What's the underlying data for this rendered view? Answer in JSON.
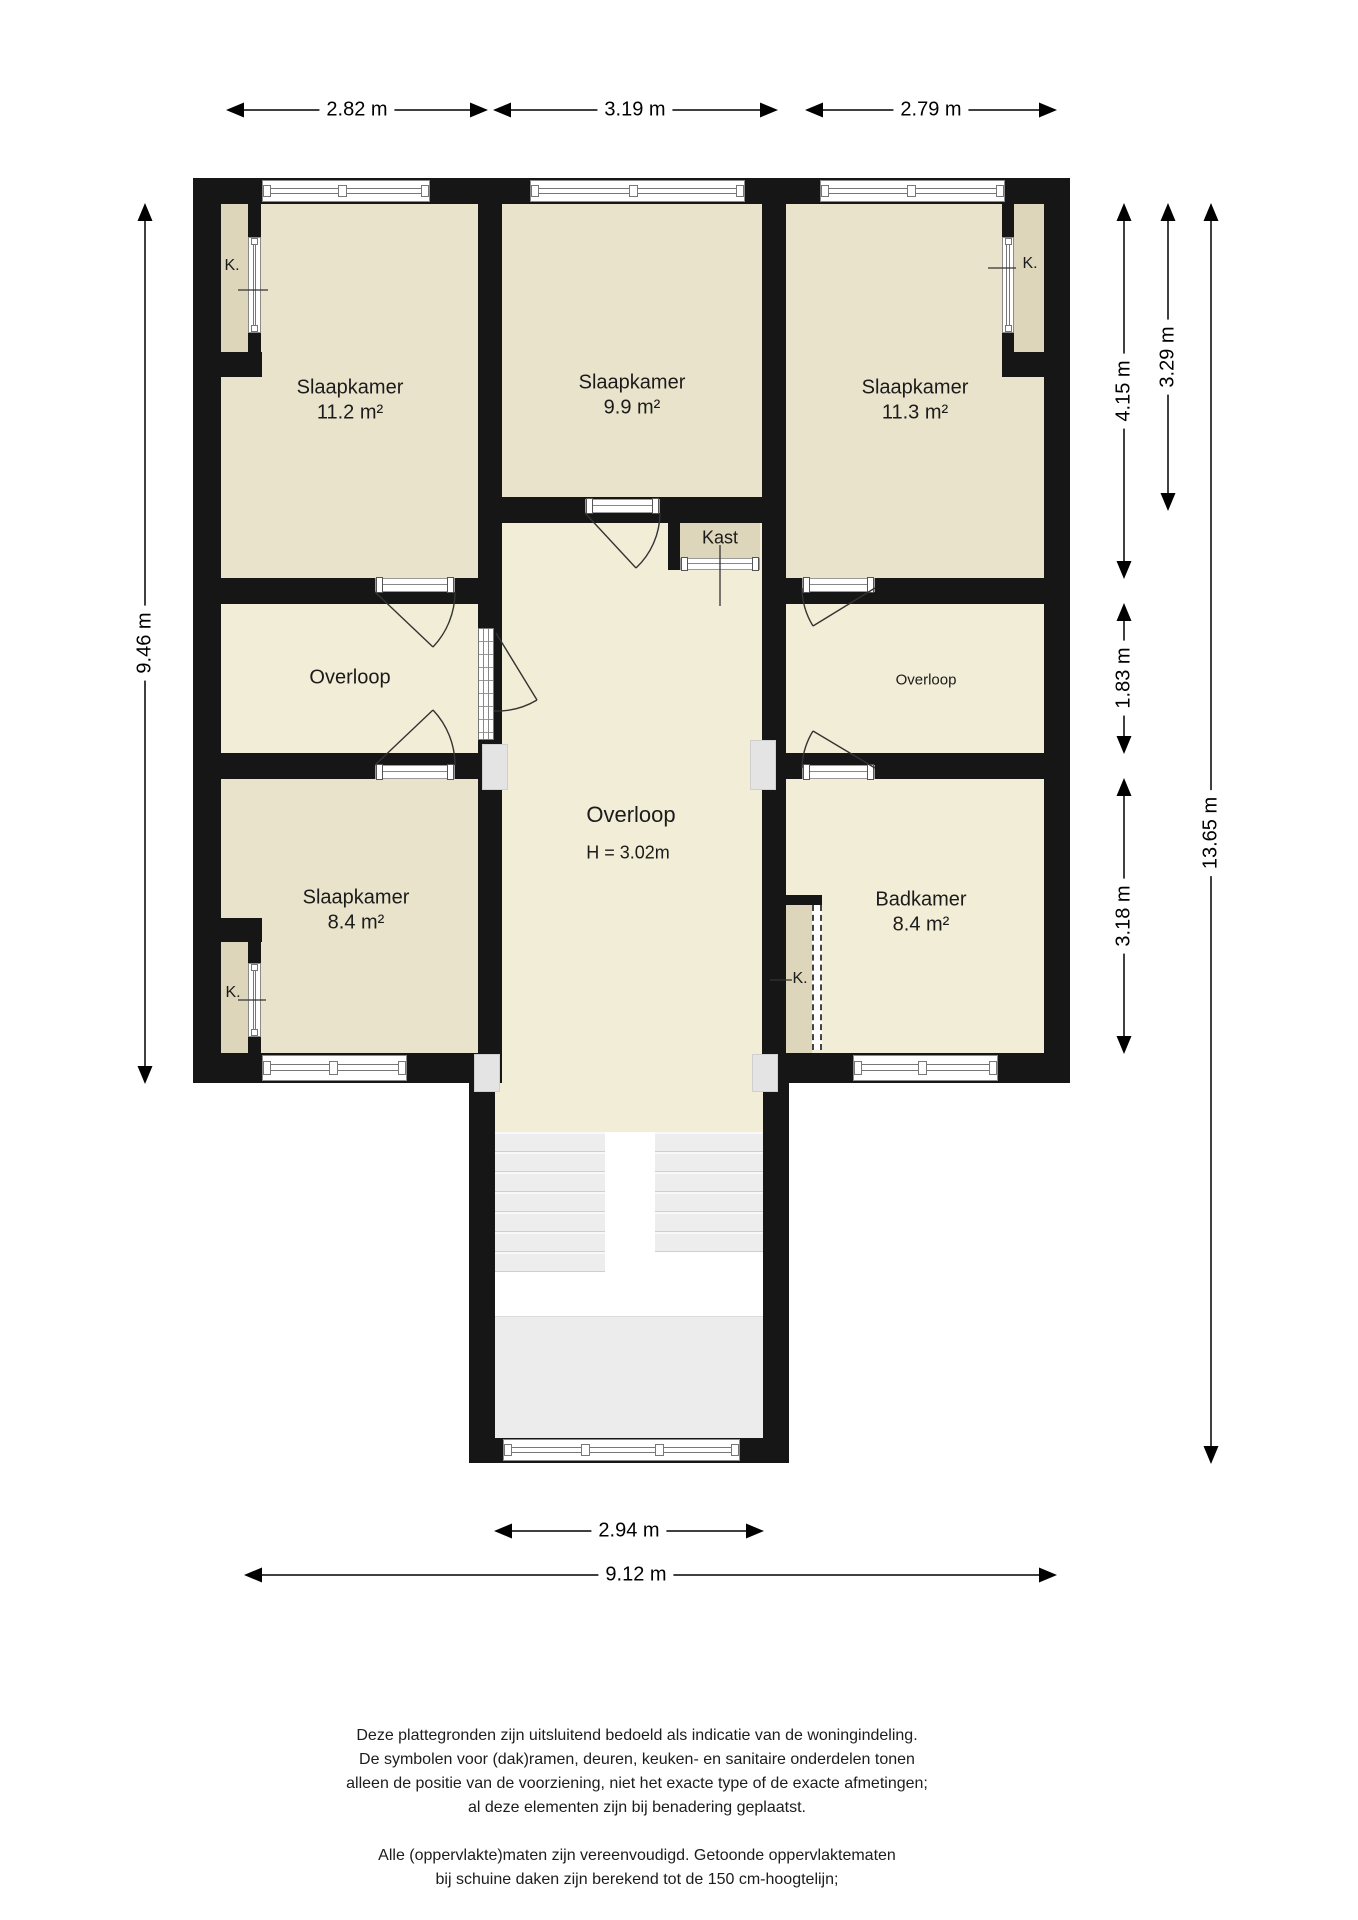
{
  "plan": {
    "rooms": [
      {
        "id": "slaapkamer-links-boven",
        "name": "Slaapkamer",
        "area": "11.2 m²"
      },
      {
        "id": "slaapkamer-midden",
        "name": "Slaapkamer",
        "area": "9.9 m²"
      },
      {
        "id": "slaapkamer-rechts-boven",
        "name": "Slaapkamer",
        "area": "11.3 m²"
      },
      {
        "id": "overloop-links",
        "name": "Overloop"
      },
      {
        "id": "overloop-rechts",
        "name": "Overloop"
      },
      {
        "id": "overloop-centraal",
        "name": "Overloop",
        "height_note": "H = 3.02m"
      },
      {
        "id": "slaapkamer-links-onder",
        "name": "Slaapkamer",
        "area": "8.4 m²"
      },
      {
        "id": "badkamer",
        "name": "Badkamer",
        "area": "8.4 m²"
      },
      {
        "id": "kast",
        "name": "Kast"
      }
    ],
    "closet_label": "K.",
    "dimensions": {
      "top_1": "2.82 m",
      "top_2": "3.19 m",
      "top_3": "2.79 m",
      "left_total": "9.46 m",
      "right_1": "4.15 m",
      "right_2": "3.29 m",
      "right_3": "1.83 m",
      "right_4": "3.18 m",
      "right_total": "13.65 m",
      "bottom_stair": "2.94 m",
      "bottom_total": "9.12 m"
    },
    "colors": {
      "wall": "#161616",
      "bedroom_fill": "#e9e3cc",
      "hall_fill": "#f1edd6",
      "closet_fill": "#ddd6bb",
      "stair_fill": "#ededed"
    }
  },
  "footer": {
    "disclaimer": [
      "Deze plattegronden zijn uitsluitend bedoeld als indicatie van de woningindeling.",
      "De symbolen voor (dak)ramen, deuren, keuken- en sanitaire onderdelen tonen",
      "alleen de positie van de voorziening, niet het exacte type of de exacte afmetingen;",
      "al deze elementen zijn bij benadering geplaatst."
    ],
    "notes": [
      "Alle (oppervlakte)maten zijn vereenvoudigd. Getoonde oppervlaktematen",
      "bij schuine daken zijn berekend tot de 150 cm-hoogtelijn;"
    ],
    "copyright": "© HUUB House Visuals 2025"
  }
}
